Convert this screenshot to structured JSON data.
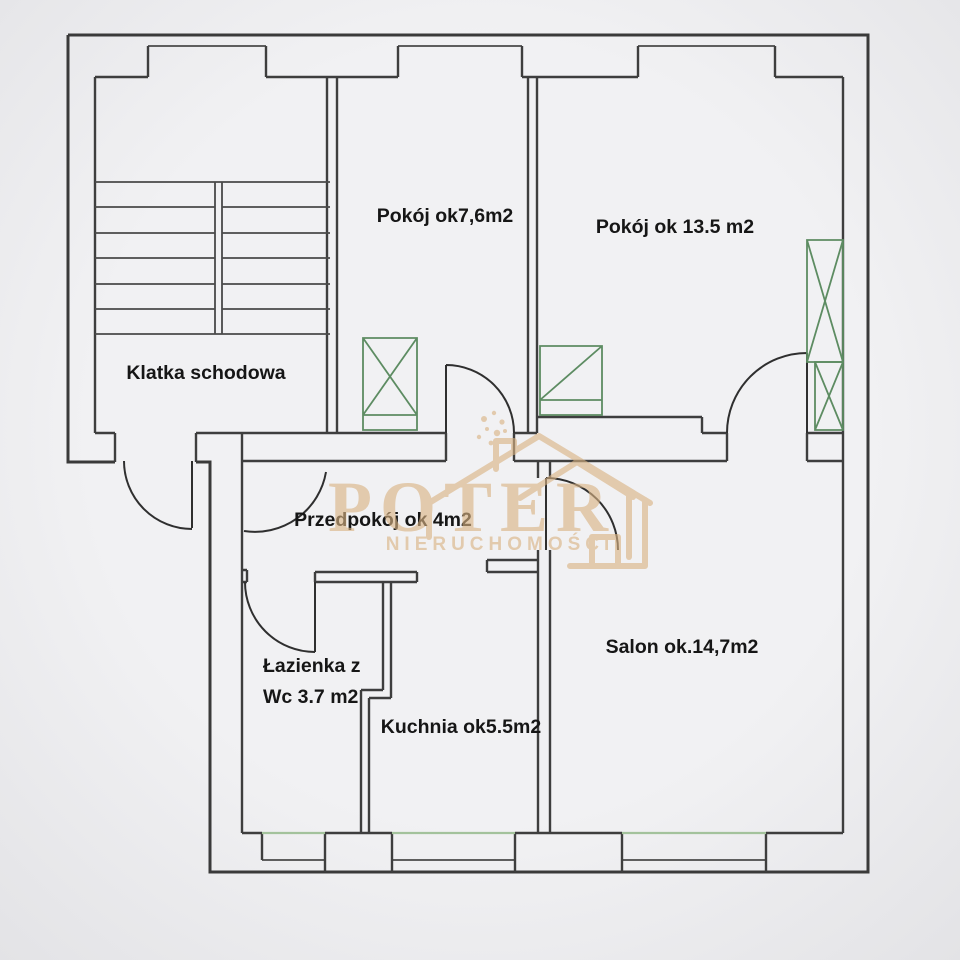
{
  "labels": {
    "klatka": {
      "text": "Klatka schodowa"
    },
    "pokoj76": {
      "text": "Pokój ok7,6m2"
    },
    "pokoj135": {
      "text": "Pokój ok 13.5 m2"
    },
    "przedpokoj": {
      "text": "Przedpokój ok 4m2"
    },
    "lazienka1": {
      "text": "Łazienka z"
    },
    "lazienka2": {
      "text": "Wc 3.7 m2"
    },
    "kuchnia": {
      "text": "Kuchnia ok5.5m2"
    },
    "salon": {
      "text": "Salon ok.14,7m2"
    }
  },
  "rooms": [
    {
      "name": "Klatka schodowa",
      "area": ""
    },
    {
      "name": "Pokój",
      "area": "ok7,6m2"
    },
    {
      "name": "Pokój",
      "area": "ok 13.5 m2"
    },
    {
      "name": "Przedpokój",
      "area": "ok 4m2"
    },
    {
      "name": "Łazienka z Wc",
      "area": "3.7 m2"
    },
    {
      "name": "Kuchnia",
      "area": "ok5.5m2"
    },
    {
      "name": "Salon",
      "area": "ok.14,7m2"
    }
  ],
  "watermark": {
    "brand": "POTER",
    "subtitle": "NIERUCHOMOŚCI"
  },
  "colors": {
    "background": "#ededee",
    "wall": "#3e3e3e",
    "furniture": "#5d8c62",
    "window_sill": "#a3c29c",
    "label_text": "#161616",
    "watermark": "#d9b383"
  }
}
